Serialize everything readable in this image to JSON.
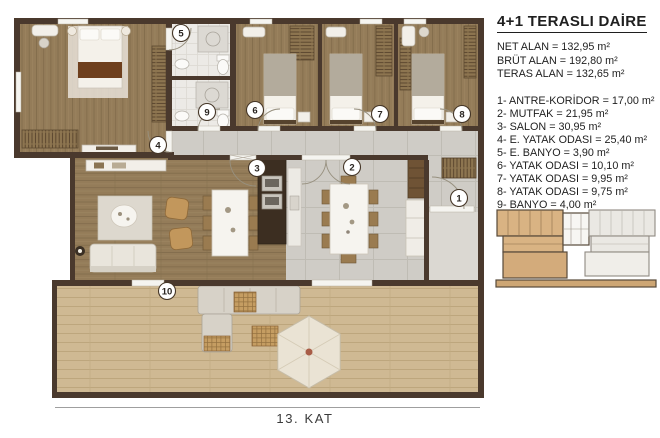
{
  "title_block": {
    "title": "4+1 TERASLI DAİRE",
    "area_lines": [
      "NET ALAN = 132,95 m²",
      "BRÜT ALAN = 192,80 m²",
      "TERAS ALAN = 132,65 m²"
    ],
    "room_lines": [
      "1- ANTRE-KORİDOR = 17,00 m²",
      "2- MUTFAK = 21,95 m²",
      "3- SALON = 30,95 m²",
      "4- E. YATAK ODASI = 25,40 m²",
      "5- E. BANYO = 3,90 m²",
      "6- YATAK ODASI = 10,10 m²",
      "7- YATAK ODASI = 9,95 m²",
      "8- YATAK ODASI = 9,75 m²",
      "9- BANYO = 4,00 m²"
    ]
  },
  "floor_label": "13. KAT",
  "plan": {
    "room_numbers": [
      {
        "n": "1",
        "x": 459,
        "y": 198
      },
      {
        "n": "2",
        "x": 352,
        "y": 167
      },
      {
        "n": "3",
        "x": 257,
        "y": 168
      },
      {
        "n": "4",
        "x": 158,
        "y": 145
      },
      {
        "n": "5",
        "x": 181,
        "y": 33
      },
      {
        "n": "6",
        "x": 255,
        "y": 110
      },
      {
        "n": "7",
        "x": 380,
        "y": 114
      },
      {
        "n": "8",
        "x": 462,
        "y": 114
      },
      {
        "n": "9",
        "x": 207,
        "y": 112
      },
      {
        "n": "10",
        "x": 167,
        "y": 291
      }
    ]
  },
  "colors": {
    "wall": "#4a392d",
    "wood_floor": "#947c59",
    "deck_floor": "#cfb993",
    "stone_floor": "#cfccc6",
    "tile_floor": "#eceae6",
    "keyplan_highlight": "#d9b383",
    "text": "#1f1f1f"
  }
}
